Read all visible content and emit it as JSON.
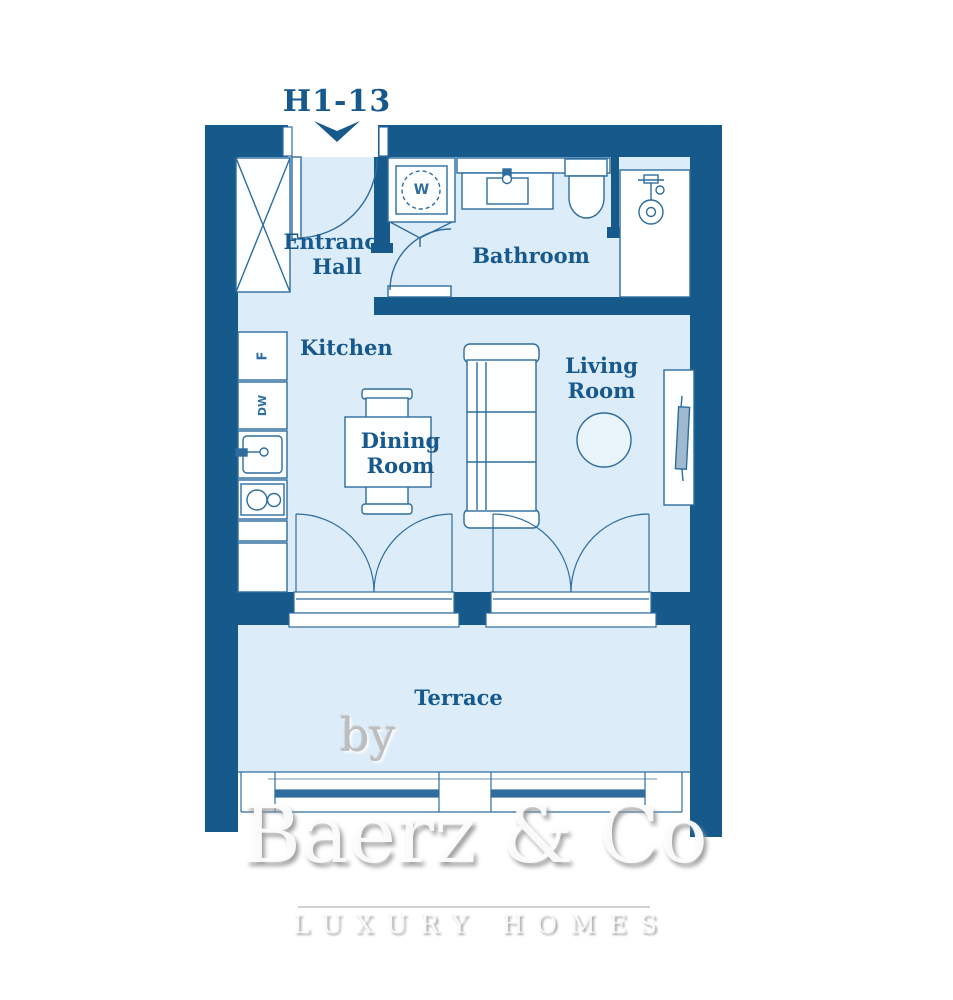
{
  "plan": {
    "unit_label": "H1-13",
    "rooms": {
      "entrance_hall": {
        "line1": "Entrance",
        "line2": "Hall"
      },
      "bathroom": {
        "label": "Bathroom"
      },
      "kitchen": {
        "label": "Kitchen"
      },
      "dining_room": {
        "line1": "Dining",
        "line2": "Room"
      },
      "living_room": {
        "line1": "Living",
        "line2": "Room"
      },
      "terrace": {
        "label": "Terrace"
      }
    },
    "appliances": {
      "fridge": "F",
      "dishwasher": "DW",
      "washing_machine": "W"
    },
    "icons": [
      "down-arrow-icon",
      "wardrobe-x-icon",
      "shower-head-icon",
      "sink-icon",
      "toilet-icon",
      "cooktop-icon",
      "sofa-icon",
      "tv-icon",
      "dining-table-icon",
      "door-swing-icon"
    ],
    "colors": {
      "wall": "#165a8c",
      "room_fill": "#dcecf8",
      "furniture_line": "#2e6d9e",
      "furniture_fill": "#fcfeff",
      "label_text": "#17598d",
      "shower_fill": "#ffffff"
    }
  },
  "watermark": {
    "by": "by",
    "brand": "Baerz & Co",
    "tagline": "LUXURY HOMES"
  }
}
